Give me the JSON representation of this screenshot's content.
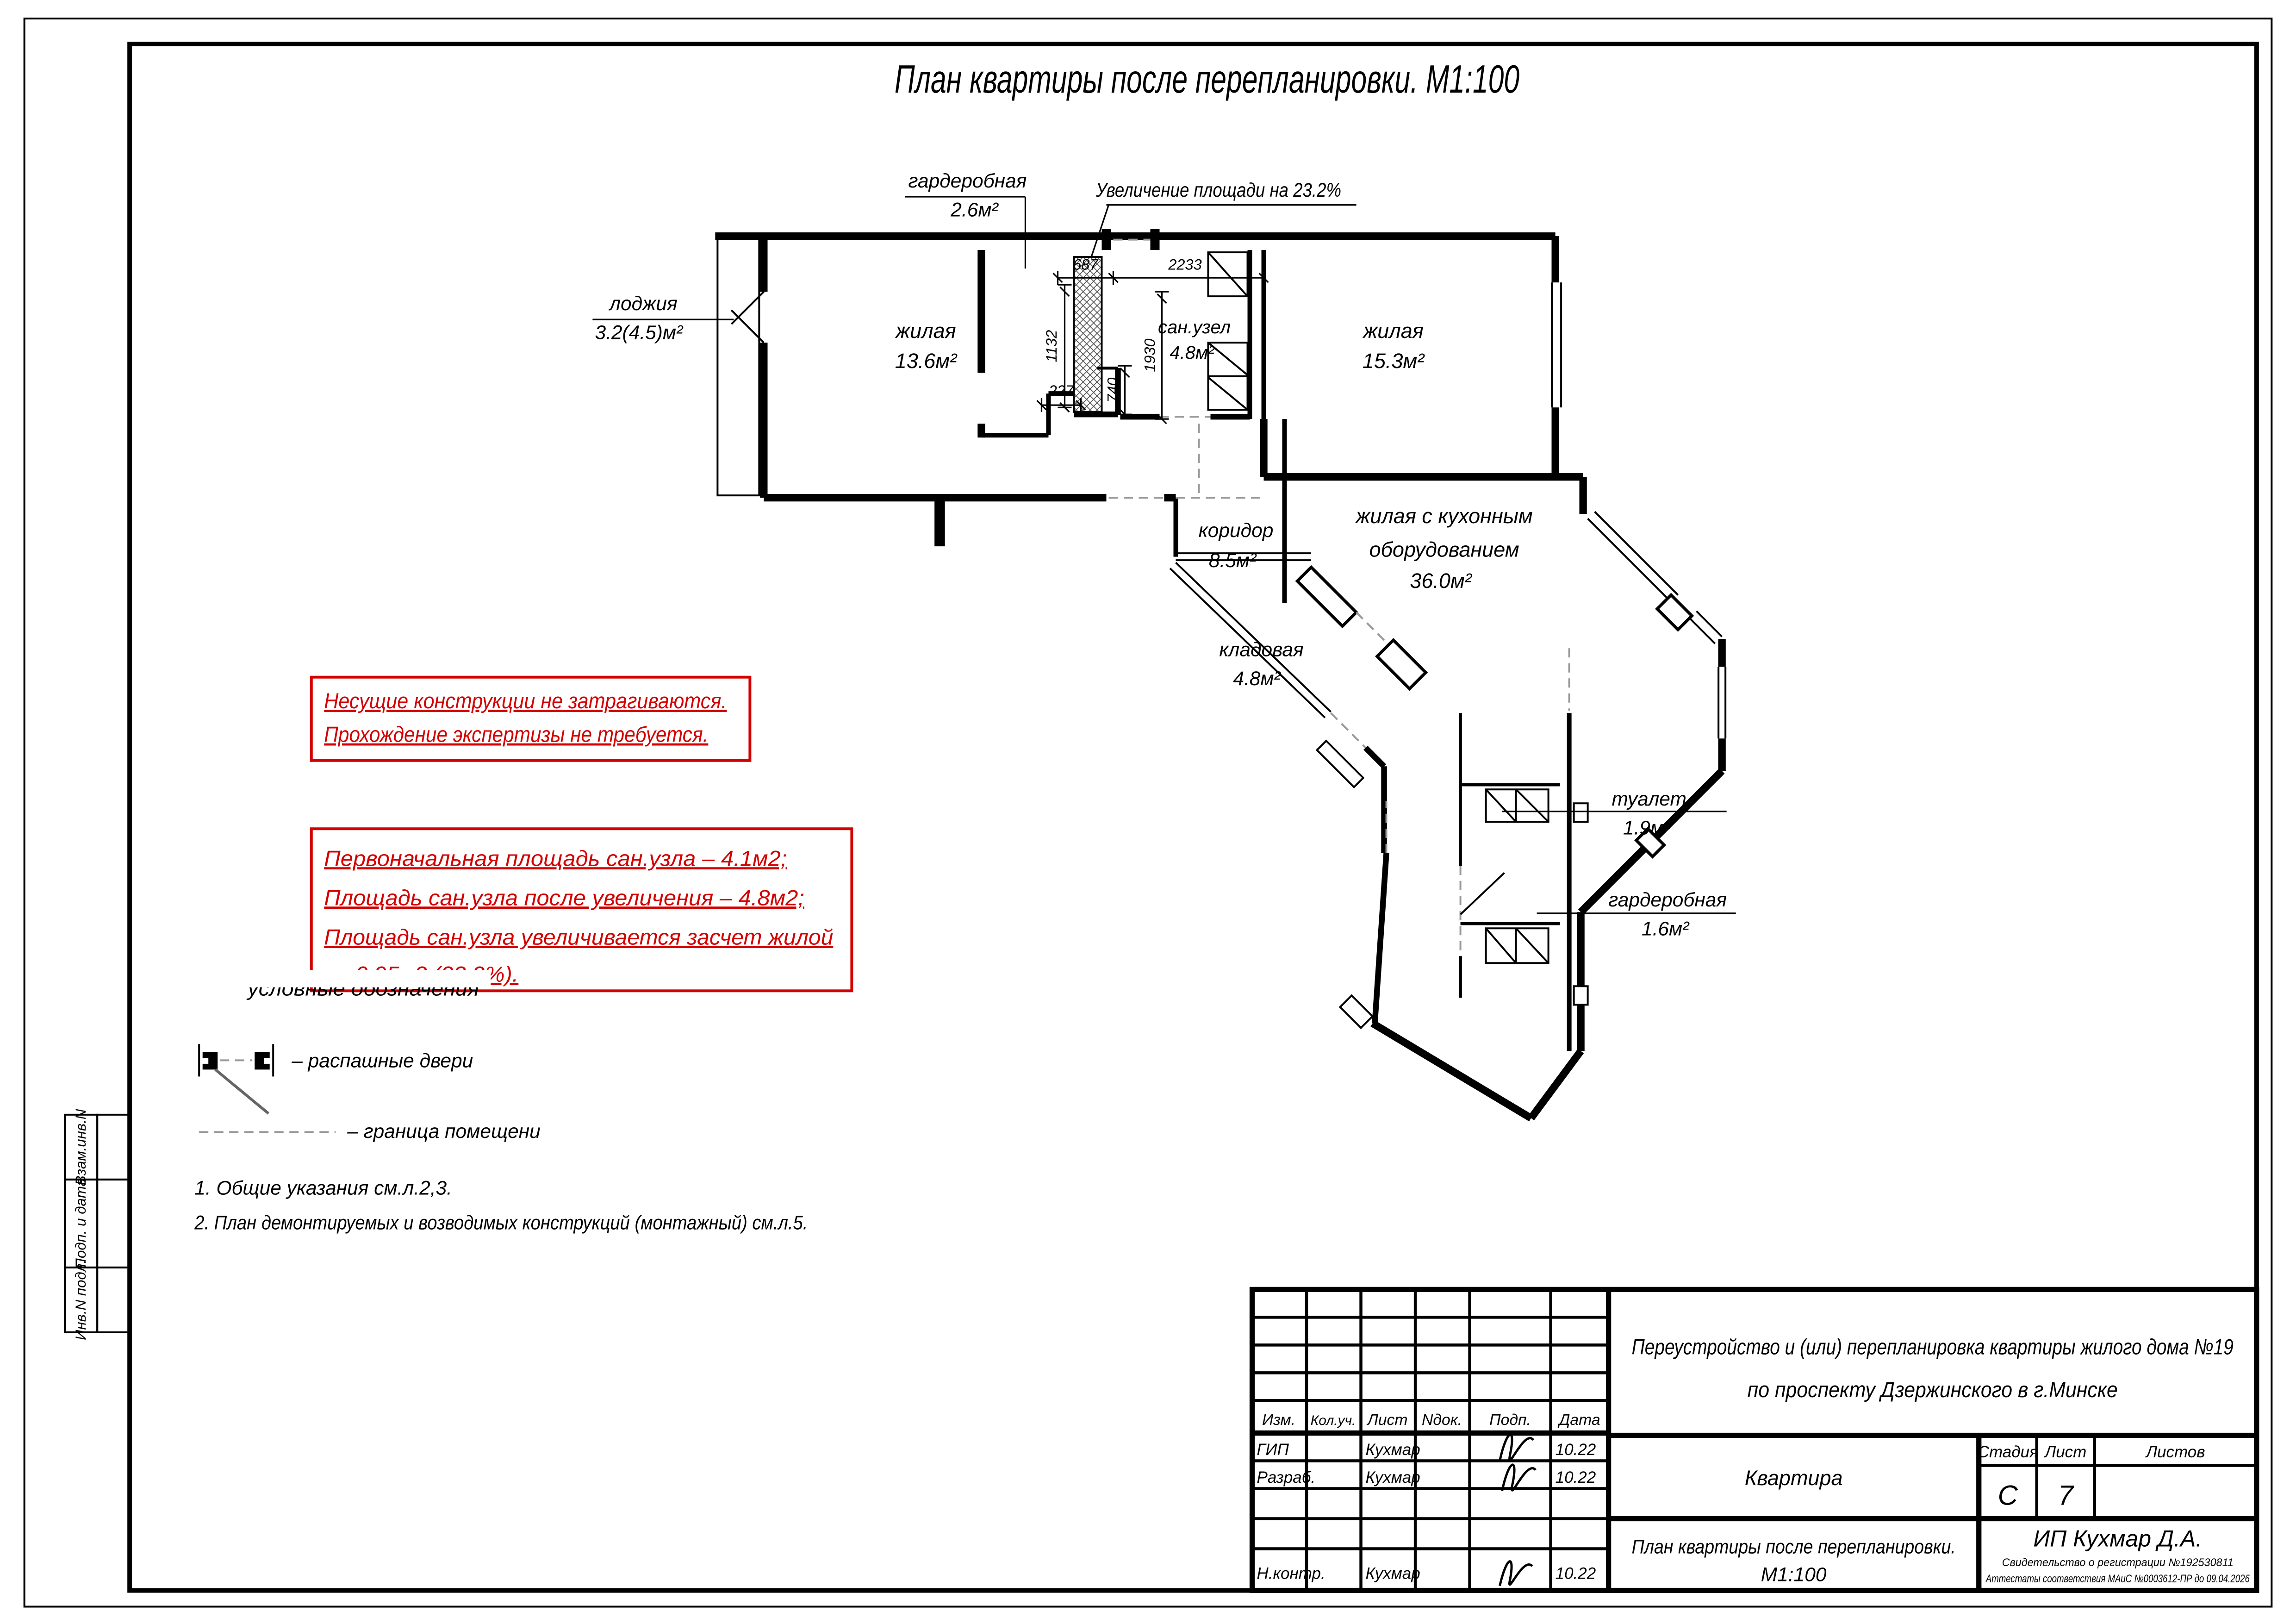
{
  "page_title": "План квартиры после перепланировки. М1:100",
  "plan": {
    "rooms": [
      {
        "name": "жилая",
        "area": "13.6м²"
      },
      {
        "name": "жилая",
        "area": "15.3м²"
      },
      {
        "name": "сан.узел",
        "area": "4.8м²"
      },
      {
        "name": "коридор",
        "area": "8.5м²"
      },
      {
        "name": "жилая с кухонным",
        "name2": "оборудованием",
        "area": "36.0м²"
      },
      {
        "name": "кладовая",
        "area": "4.8м²"
      },
      {
        "name": "туалет",
        "area": "1.9м²"
      },
      {
        "name": "гардеробная",
        "area": "1.6м²"
      },
      {
        "name": "гардеробная",
        "area": "2.6м²"
      },
      {
        "name": "лоджия",
        "area": "3.2(4.5)м²"
      }
    ],
    "increase_note": "Увеличение площади на 23.2%",
    "dims": {
      "d1132": "1132",
      "d687": "687",
      "d2233": "2233",
      "d1930": "1930",
      "d227": "227",
      "d740": "740"
    }
  },
  "red_notes": {
    "box1": [
      "Несущие конструкции не затрагиваются.",
      "Прохождение экспертизы не требуется."
    ],
    "box2": [
      "Первоначальная площадь сан.узла – 4.1м2;",
      "Площадь сан.узла после увеличения – 4.8м2;",
      "Площадь сан.узла увеличивается засчет жилой",
      "на 0.95м2 (23,2%)."
    ]
  },
  "legend": {
    "header": "условные обозначения",
    "door": "– распашные двери",
    "boundary": "– граница помещени"
  },
  "notes": [
    "1. Общие указания см.л.2,3.",
    "2. План демонтируемых и возводимых конструкций (монтажный) см.л.5."
  ],
  "side_labels": [
    "Взам.инв.N",
    "Подп. и дата",
    "Инв.N подл."
  ],
  "titleblock": {
    "cols": [
      "Изм.",
      "Кол.уч.",
      "Лист",
      "Nдок.",
      "Подп.",
      "Дата"
    ],
    "rows": [
      {
        "role": "ГИП",
        "name": "Кухмар",
        "date": "10.22"
      },
      {
        "role": "Разраб.",
        "name": "Кухмар",
        "date": "10.22"
      },
      {
        "role": "Н.контр.",
        "name": "Кухмар",
        "date": "10.22"
      }
    ],
    "project_line1": "Переустройство и (или) перепланировка квартиры жилого дома №19",
    "project_line2": "по проспекту Дзержинского в г.Минске",
    "object": "Квартира",
    "stage_label": "Стадия",
    "sheet_label": "Лист",
    "sheets_label": "Листов",
    "stage": "С",
    "sheet_no": "7",
    "drawing_title_line1": "План квартиры после перепланировки.",
    "drawing_title_line2": "М1:100",
    "company": "ИП Кухмар Д.А.",
    "cert1": "Свидетельство о регистрации №192530811",
    "cert2": "Аттестаты соответствия МАиС №0003612-ПР до 09.04.2026"
  }
}
